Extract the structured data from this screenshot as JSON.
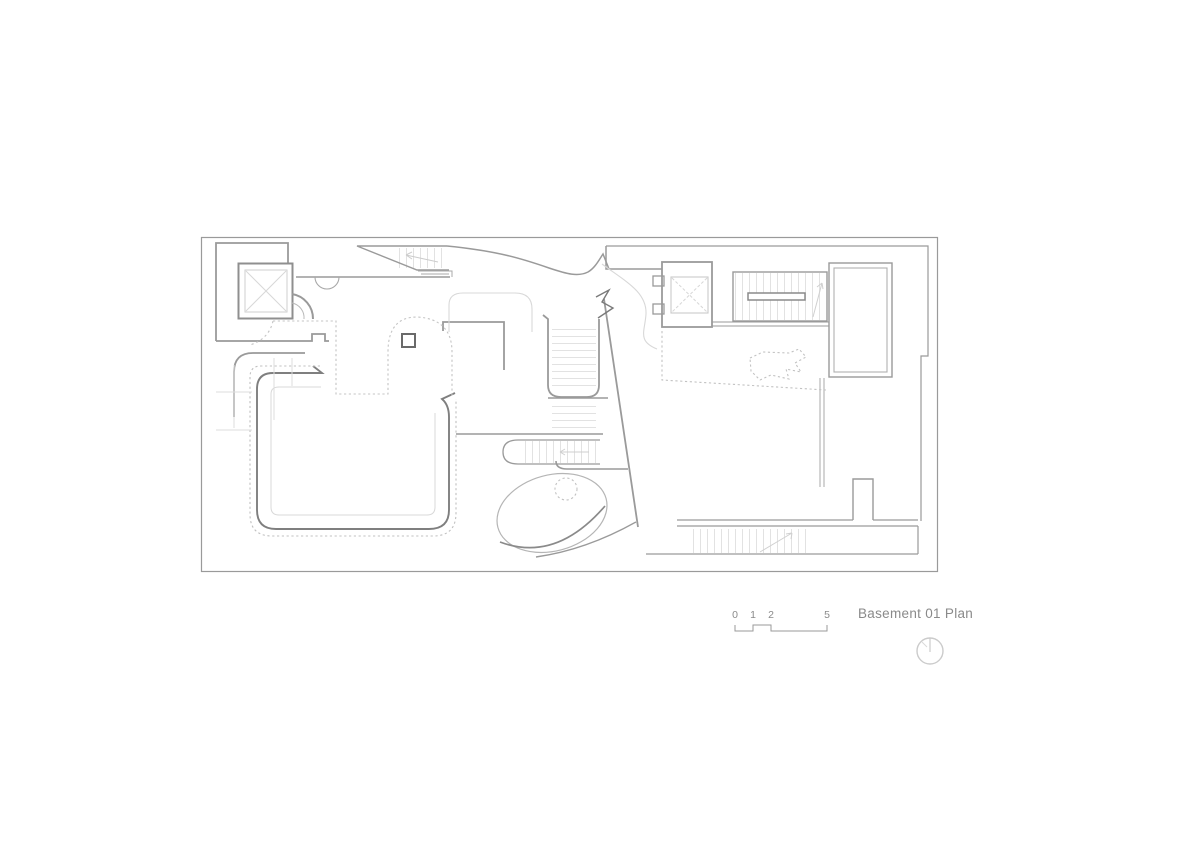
{
  "sheet": {
    "title": "Basement 01 Plan",
    "scale_bar": {
      "labels": [
        "0",
        "1",
        "2",
        "5"
      ]
    },
    "north_indicator_icon": "compass-circle-with-needle",
    "colors": {
      "wall": "#8f8f8f",
      "wall_dark": "#6f6f6f",
      "wall_light": "#b5b5b5",
      "ghost_line": "#d8d8d8",
      "dashed_line": "#c4c4c4",
      "hatch": "#e2e2e2",
      "annotation_text": "#8a8a8a",
      "background": "#ffffff"
    }
  }
}
